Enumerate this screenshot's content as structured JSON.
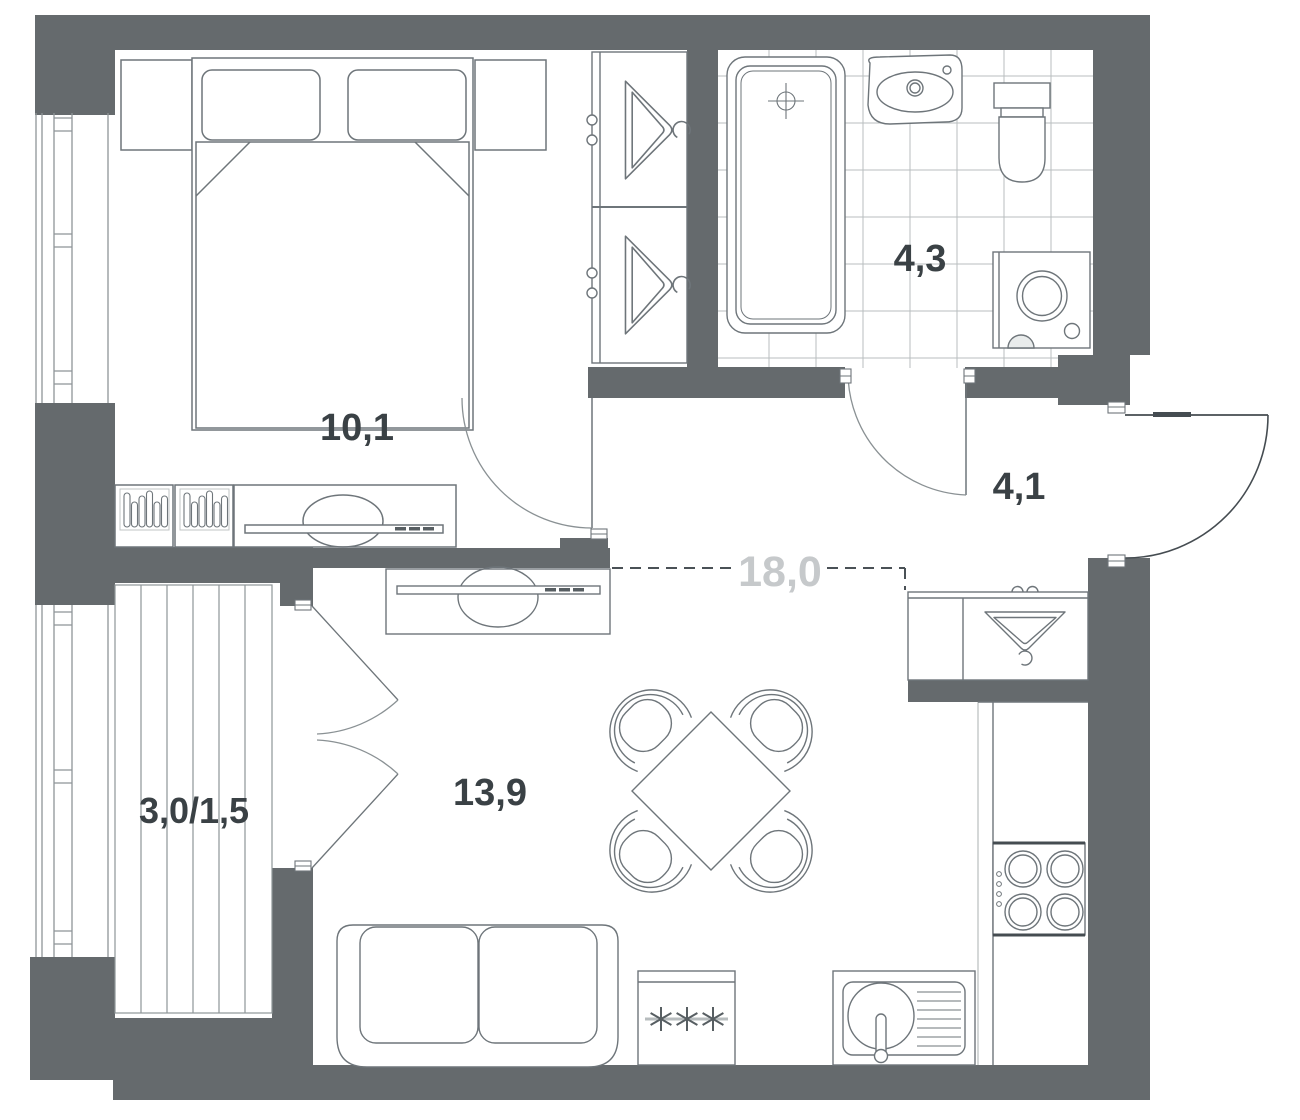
{
  "plan": {
    "title": "apartment-floor-plan",
    "area_units": "m2",
    "rooms": {
      "bedroom": {
        "name": "bedroom",
        "area_label": "10,1"
      },
      "bathroom": {
        "name": "bathroom",
        "area_label": "4,3"
      },
      "hallway": {
        "name": "hallway",
        "area_label": "4,1"
      },
      "living_kitchen": {
        "name": "living-kitchen",
        "area_label": "13,9"
      },
      "combined": {
        "name": "combined-living-area",
        "area_label": "18,0"
      },
      "balcony": {
        "name": "balcony",
        "area_label": "3,0/1,5"
      }
    },
    "fixtures": [
      "double-bed",
      "pillows",
      "nightstand-left",
      "nightstand-right",
      "dresser",
      "tv-console",
      "wardrobe-with-hangers",
      "bathtub",
      "washbasin",
      "toilet",
      "washing-machine",
      "interior-door",
      "entrance-door",
      "balcony-french-doors",
      "coat-closet-with-hanger",
      "dining-table",
      "dining-chairs",
      "sofa",
      "tv-stand",
      "fridge-freezer",
      "kitchen-sink",
      "cooktop",
      "window",
      "balcony-decking",
      "tiled-floor"
    ],
    "colors": {
      "wall": "#656a6d",
      "line": "#6e757a",
      "dark_line": "#454c51",
      "light_line": "#b9bebf",
      "text": "#3a4145",
      "muted_text": "#c6c9cb",
      "background": "#ffffff"
    }
  }
}
